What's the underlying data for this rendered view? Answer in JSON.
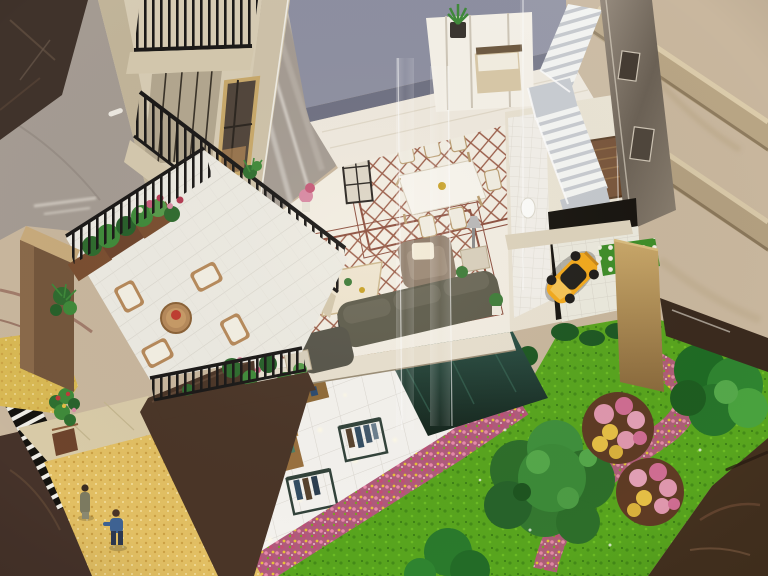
{
  "scene": {
    "type": "photograph",
    "subject": "cut-away architectural scale model of a multi-storey shop-house viewed from above",
    "setting": "model stands on a grey marble lobby floor beside a large beige marble pillar",
    "visible_text": "none"
  },
  "palette": {
    "marble_beige": "#c9b79e",
    "marble_gray": "#a59c93",
    "marble_dark": "#40332b",
    "plinth_brown": "#3a2a1e",
    "corner_brown": "#44311f",
    "facade_cream": "#d8cdb5",
    "slab_gray": "#8e90a2",
    "wall_white": "#f0eadf",
    "stair_light": "#eef0f2",
    "mirror_tan": "#857a6e",
    "railing_black": "#1a1817",
    "lattice_cream": "#f3eee3",
    "patio_tile": "#edebe3",
    "wood_tan": "#b6895a",
    "cushion_white": "#f4f0e4",
    "sofa_olive": "#5f5d4d",
    "armchair_taupe": "#8d7b69",
    "coffee_table_cream": "#efe5d0",
    "car_yellow": "#f3a91c",
    "teal_glass": "#24423a",
    "gold_wall": "#b0925a",
    "retail_tile": "#f5f3ef",
    "shelf_wood": "#a87c42",
    "rack_frame": "#32423a",
    "grass_green": "#58a51e",
    "tree_dark": "#2d6e2a",
    "tree_mid": "#3f8f3c",
    "flower_pink": "#df97ad",
    "flower_bed": "#b05a7c",
    "walkway_yellow": "#e2bf63",
    "walkway_beige": "#d9cba8",
    "wall_brown": "#4a3527",
    "figure_olive": "#7c7a60",
    "figure_blue": "#3e6292",
    "plant_green": "#3f7d3a"
  },
  "inventory": {
    "building": {
      "balcony_levels": 3,
      "staircase": "white switch-back stair behind acrylic",
      "bedroom": "upper bedroom with bed behind mirrored panels",
      "garage_car": "yellow sports car parked on tiled garage deck"
    },
    "interior": {
      "dining_chairs": 6,
      "dining_table": 1,
      "sofas": 1,
      "armchairs": 1,
      "coffee_table": 1,
      "floor": "cream marble with rust diamond-lattice rug borders"
    },
    "terrace": {
      "lounge_chairs": 4,
      "round_table": 1,
      "planter_boxes": 3
    },
    "retail_level": {
      "wood_display_units": 5,
      "metal_clothing_racks": 4,
      "white_tables": 2
    },
    "garden": {
      "large_green_trees": 2,
      "flowering_trees": 2,
      "winding_flower_path": 1,
      "hedges": 3
    },
    "street": {
      "pedestrian_figures": 2,
      "flower_planter_tower": 1
    }
  }
}
